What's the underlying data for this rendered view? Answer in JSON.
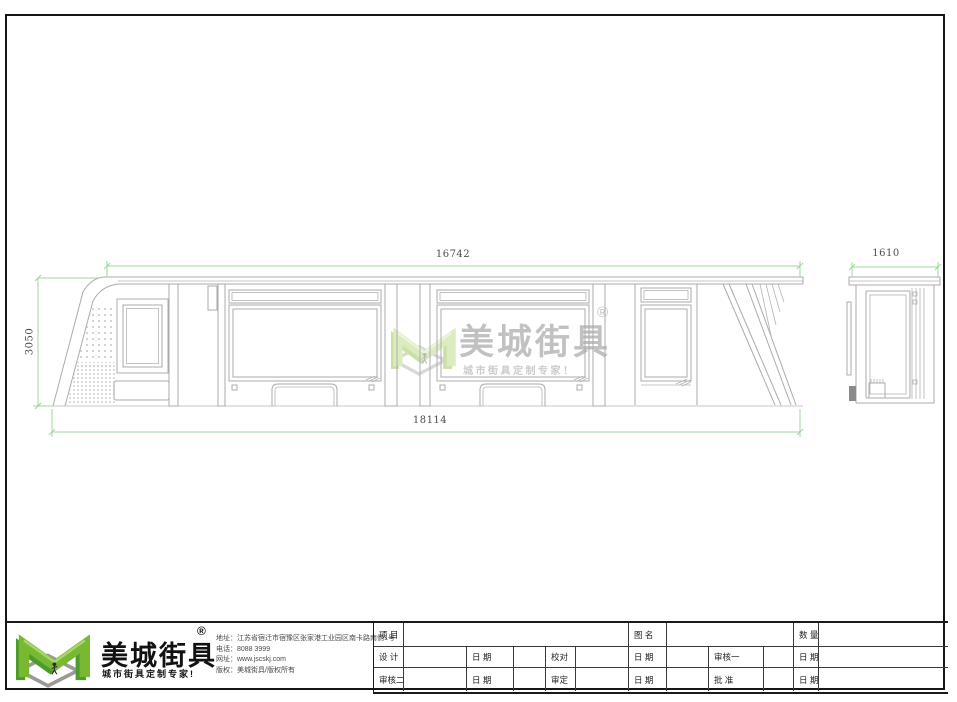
{
  "drawing": {
    "dimensions": {
      "top_width": "16742",
      "side_width": "1610",
      "height": "3050",
      "total_width": "18114"
    }
  },
  "watermark": {
    "brand": "美城街具",
    "reg": "®",
    "tagline": "城市街具定制专家！"
  },
  "title_block": {
    "logo": {
      "brand": "美城街具",
      "reg": "®",
      "tagline": "城市街具定制专家!"
    },
    "contact": {
      "address": "地址：江苏省宿迁市宿豫区张家港工业园区南卡路南侧1号",
      "phone": "电话：8088 3999",
      "website": "网址：www.jscskj.com",
      "copyright": "版权：美城街具/版权所有"
    },
    "table": {
      "rows": [
        [
          "项 目",
          "图 名",
          "数 量"
        ],
        [
          "设 计",
          "日 期",
          "校对",
          "日 期",
          "审核一",
          "日 期"
        ],
        [
          "审核二",
          "日 期",
          "审定",
          "日 期",
          "批 准",
          "日 期"
        ]
      ]
    }
  },
  "colors": {
    "dimension_green": "#9fd69b",
    "line_gray": "#ababab",
    "logo_green": "#79b833",
    "logo_green_dark": "#4e9b2d",
    "shadow_gray": "#9a9a9a"
  }
}
